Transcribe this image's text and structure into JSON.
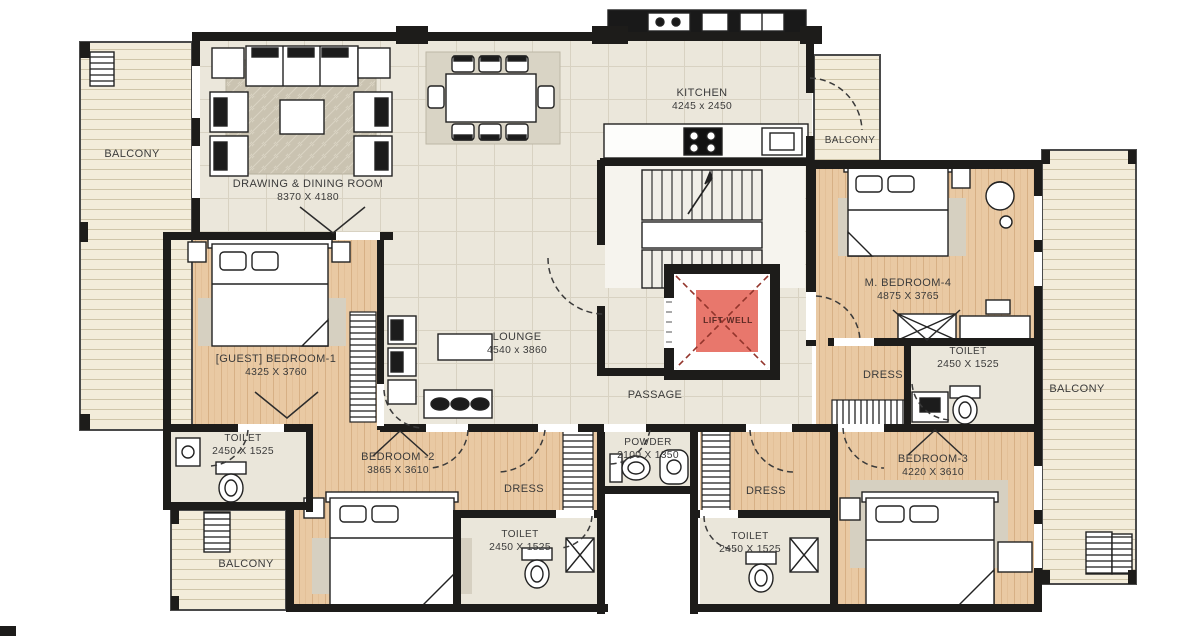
{
  "title": "Apartment Floor Plan",
  "colors": {
    "wall": "#1d1c1a",
    "lift_well_fill": "#e8776c",
    "wood_floor": "#e9c9a3",
    "tile_floor": "#ebe7db",
    "balcony_floor": "#f3ecda",
    "rug": "#cac3b1"
  },
  "rooms": {
    "balcony_top_left": {
      "label": "BALCONY"
    },
    "drawing_dining": {
      "label": "DRAWING & DINING ROOM",
      "dims": "8370 X 4180"
    },
    "kitchen": {
      "label": "KITCHEN",
      "dims": "4245 x 2450"
    },
    "balcony_kitchen": {
      "label": "BALCONY"
    },
    "m_bedroom_4": {
      "label": "M. BEDROOM-4",
      "dims": "4875 X 3765"
    },
    "lift_well": {
      "label": "LIFT WELL"
    },
    "lounge": {
      "label": "LOUNGE",
      "dims": "4540 x 3860"
    },
    "passage": {
      "label": "PASSAGE"
    },
    "guest_bedroom_1": {
      "label": "[GUEST] BEDROOM-1",
      "dims": "4325 X 3760"
    },
    "toilet_guest": {
      "label": "TOILET",
      "dims": "2450 X 1525"
    },
    "bedroom_2": {
      "label": "BEDROOM -2",
      "dims": "3865 X 3610"
    },
    "dress_left": {
      "label": "DRESS"
    },
    "powder": {
      "label": "POWDER",
      "dims": "2100 X 1350"
    },
    "toilet_bottom_left": {
      "label": "TOILET",
      "dims": "2450 X 1525"
    },
    "dress_right": {
      "label": "DRESS"
    },
    "toilet_bottom_right": {
      "label": "TOILET",
      "dims": "2450 X 1525"
    },
    "bedroom_3": {
      "label": "BEDROOM-3",
      "dims": "4220 X 3610"
    },
    "dress_m4": {
      "label": "DRESS"
    },
    "toilet_m4": {
      "label": "TOILET",
      "dims": "2450 X 1525"
    },
    "balcony_right": {
      "label": "BALCONY"
    },
    "balcony_bottom_left": {
      "label": "BALCONY"
    }
  }
}
